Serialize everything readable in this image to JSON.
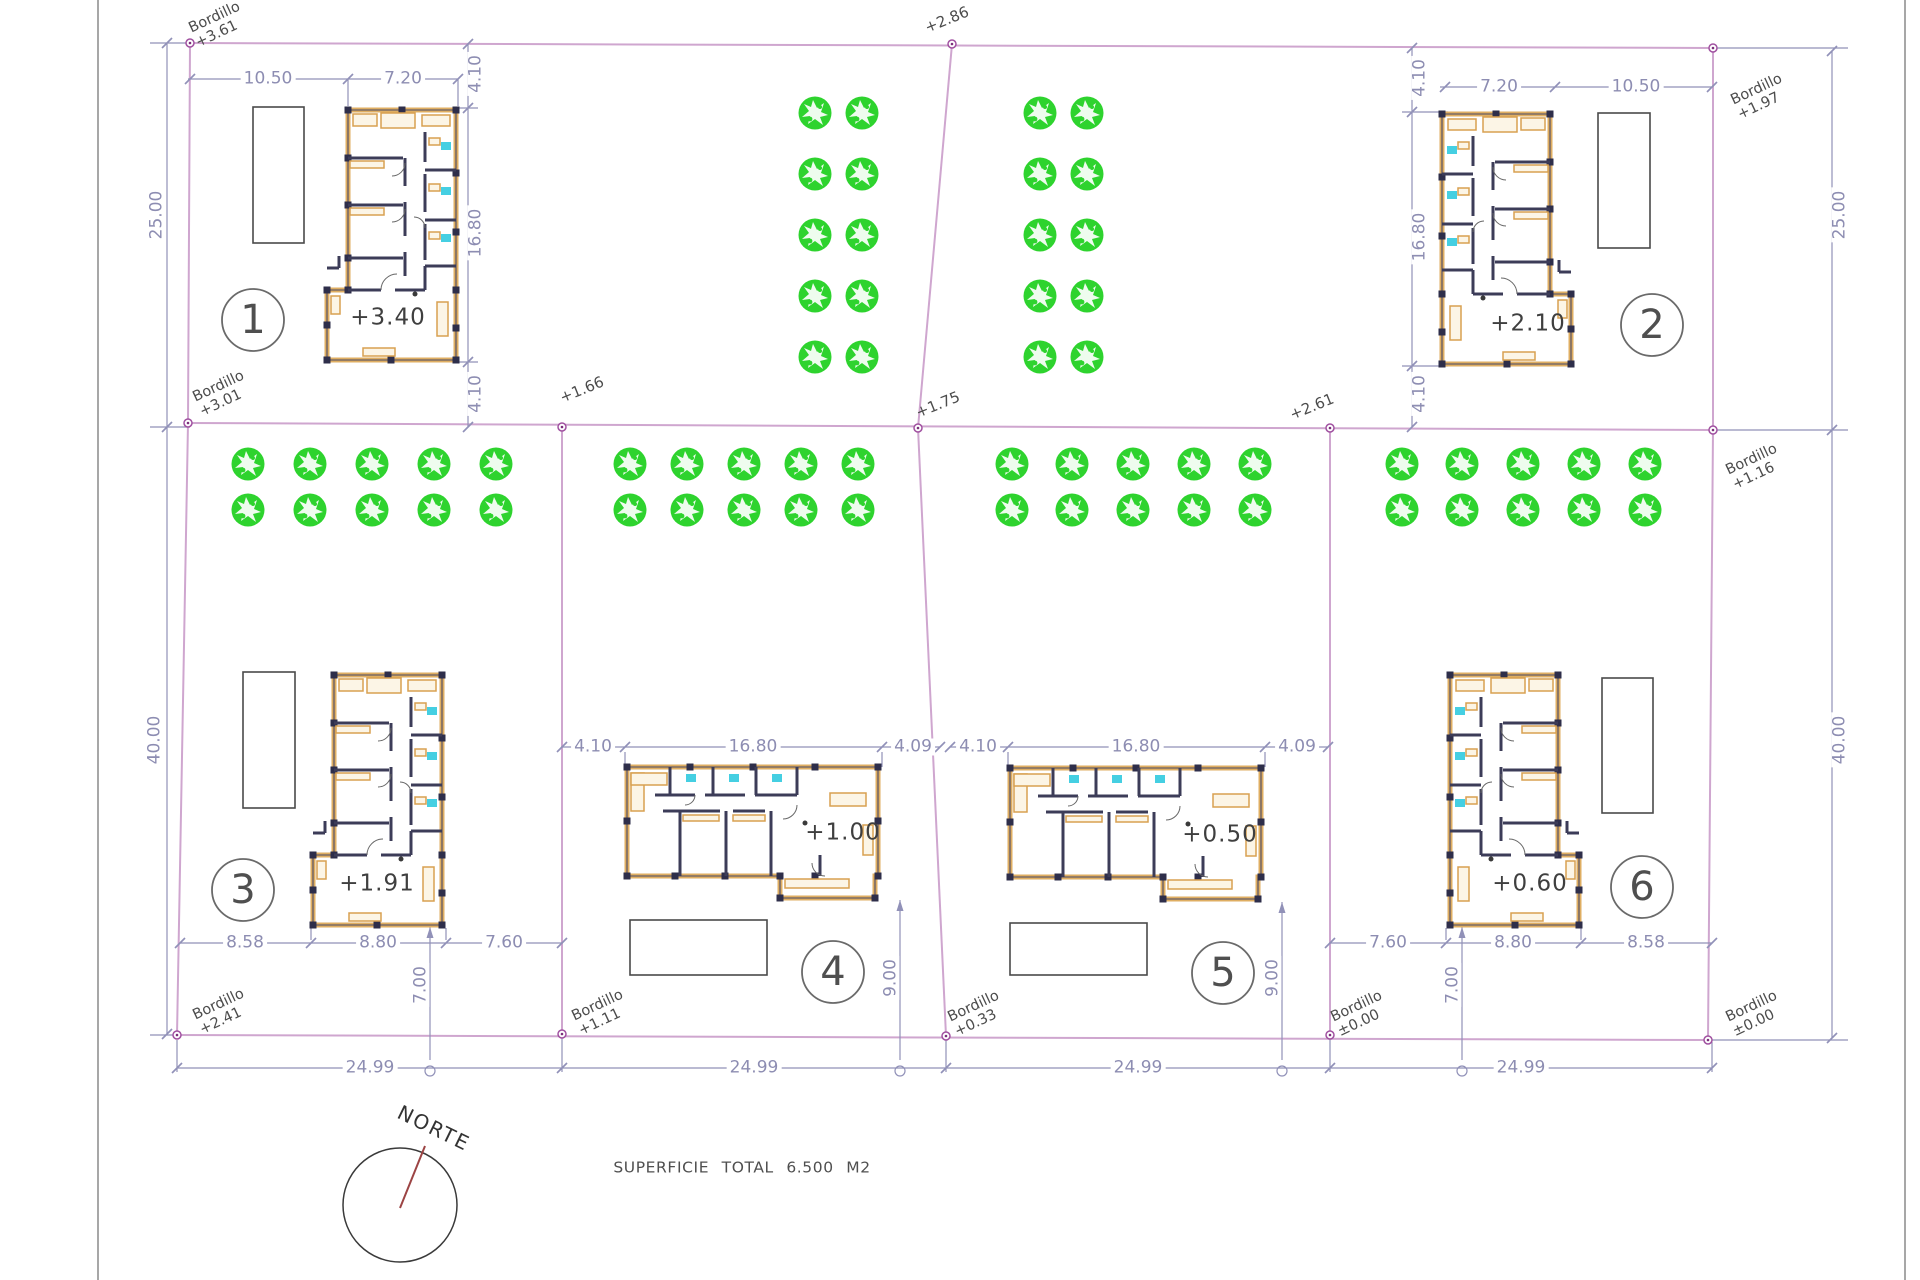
{
  "drawing": {
    "north_label": "NORTE",
    "total_area_label": "SUPERFICIE TOTAL 6.500 M2",
    "curb_word": "Bordillo",
    "curbs": {
      "top_left": "+3.61",
      "mid_left": "+3.01",
      "bottom_left": "+2.41",
      "top_right": "+1.97",
      "mid_right": "+1.16",
      "bottom_right": "±0.00",
      "bottom_mid_left": "+1.11",
      "bottom_mid_center": "+0.33",
      "bottom_mid_right": "±0.00"
    },
    "street_points": {
      "top": "+2.86",
      "mid_left": "+1.66",
      "mid_center": "+1.75",
      "mid_right": "+2.61"
    },
    "site_dimensions": {
      "left_top": "25.00",
      "left_bottom": "40.00",
      "right_top": "25.00",
      "right_bottom": "40.00",
      "bottom": [
        "24.99",
        "24.99",
        "24.99",
        "24.99"
      ]
    },
    "plots": [
      {
        "number": "1",
        "floor_level": "+3.40",
        "dims": {
          "a": "10.50",
          "b": "7.20",
          "c": "4.10",
          "d": "16.80",
          "e": "4.10"
        }
      },
      {
        "number": "2",
        "floor_level": "+2.10",
        "dims": {
          "a": "7.20",
          "b": "10.50",
          "c": "4.10",
          "d": "16.80",
          "e": "4.10"
        }
      },
      {
        "number": "3",
        "floor_level": "+1.91",
        "dims": {
          "a": "8.58",
          "b": "8.80",
          "c": "7.60",
          "d": "7.00"
        }
      },
      {
        "number": "4",
        "floor_level": "+1.00",
        "dims": {
          "a": "4.10",
          "b": "16.80",
          "c": "4.09",
          "d": "9.00"
        }
      },
      {
        "number": "5",
        "floor_level": "+0.50",
        "dims": {
          "a": "4.10",
          "b": "16.80",
          "c": "4.09",
          "d": "9.00"
        }
      },
      {
        "number": "6",
        "floor_level": "+0.60",
        "dims": {
          "a": "7.60",
          "b": "8.80",
          "c": "8.58",
          "d": "7.00"
        }
      }
    ]
  }
}
